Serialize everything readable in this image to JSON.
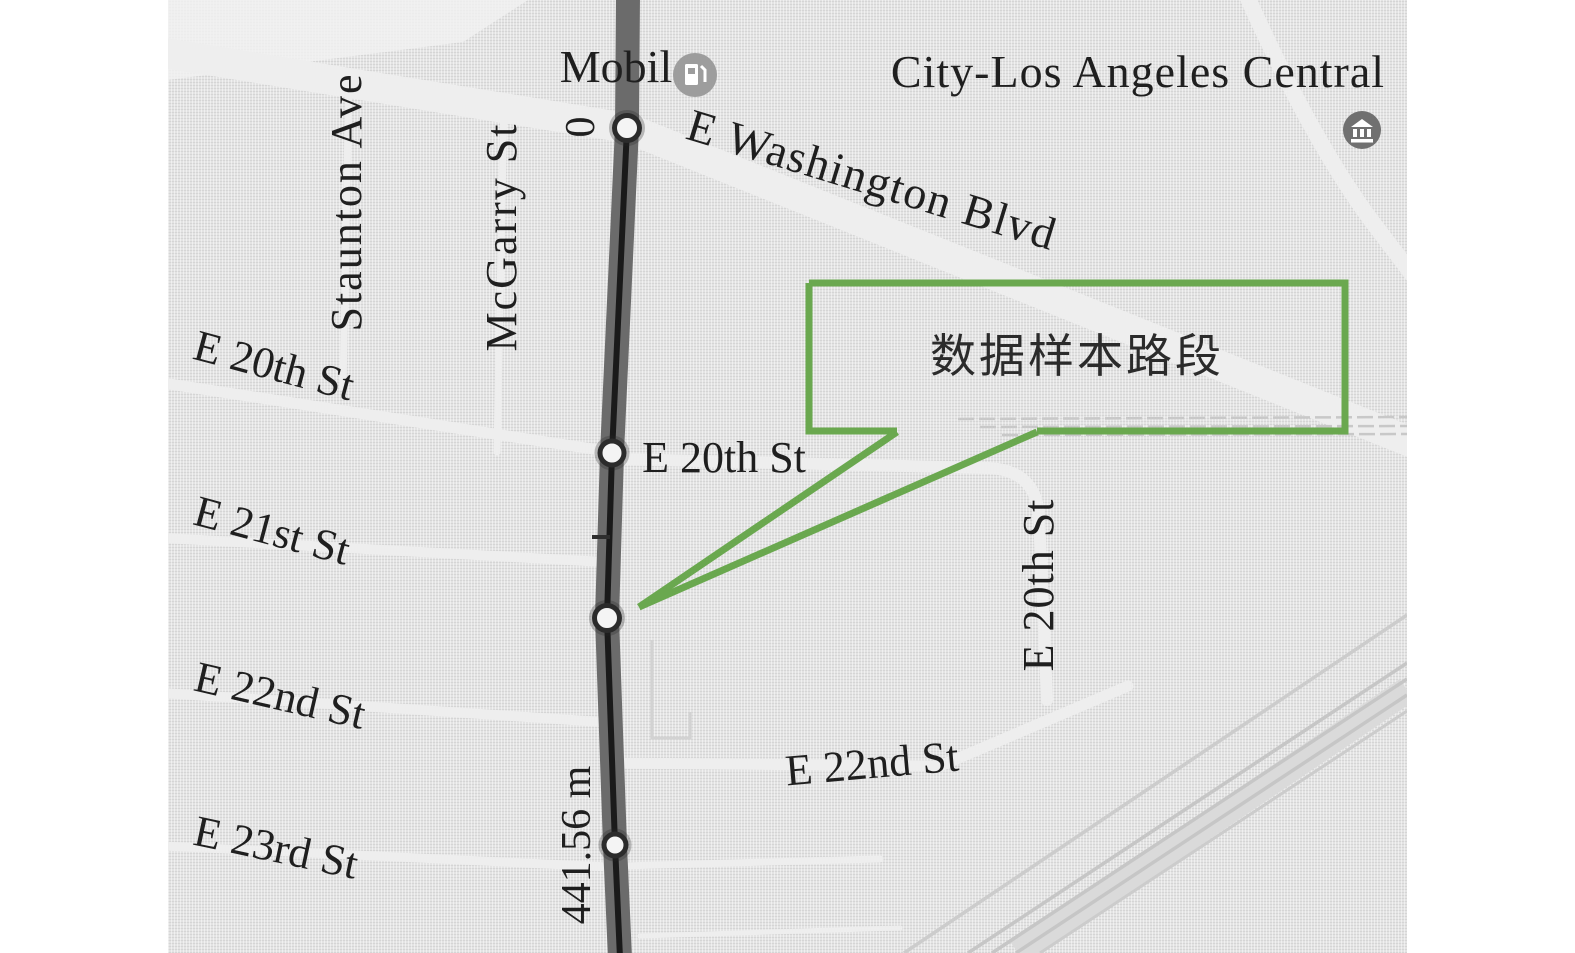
{
  "figure": {
    "type": "annotated-street-map",
    "region": "Los Angeles Central",
    "description_visible_text_only": true
  },
  "colors": {
    "callout-green": "#6aa84f",
    "map-bg": "#e3e3e3",
    "road-dark": "#6b6b6b",
    "road-core": "#1a1a1a",
    "label-ink": "#1f1f1f"
  },
  "labels": {
    "mobil": "Mobil",
    "city": "City-Los Angeles Central",
    "washington": "E Washington Blvd",
    "staunton": "Staunton Ave",
    "mcgarry": "McGarry St",
    "e20_left": "E 20th St",
    "e21_left": "E 21st St",
    "e22_left": "E 22nd St",
    "e23_left": "E 23rd St",
    "e20_mid": "E 20th St",
    "e20_right": "E 20th St",
    "e22_mid": "E 22nd St",
    "segment_start": "0",
    "segment_length": "441.56 m",
    "callout": "数据样本路段"
  },
  "icons": {
    "gas": "gas-station-icon",
    "museum": "museum-icon"
  },
  "sample_segment": {
    "start_label": "0",
    "end_label": "441.56 m",
    "length_m": 441.56,
    "marker_count": 4,
    "highlight_road": "McGarry St corridor (vertical dark route)"
  }
}
